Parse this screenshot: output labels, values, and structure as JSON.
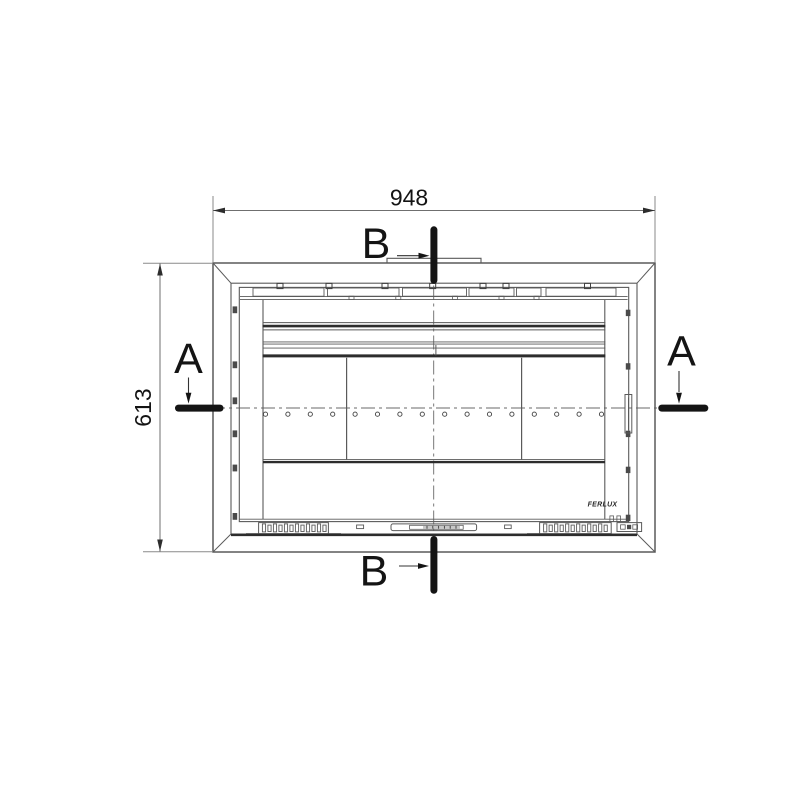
{
  "drawing": {
    "dimensions": {
      "width_label": "948",
      "height_label": "613"
    },
    "sections": {
      "a_left": "A",
      "a_right": "A",
      "b_top": "B",
      "b_bottom": "B"
    },
    "logo": "FERLUX",
    "colors": {
      "background": "#ffffff",
      "dimension_line": "#8a8a8a",
      "drawing_line": "#5a5a5a",
      "thick_band": "#2d2d2d",
      "section_marker": "#141414"
    }
  }
}
